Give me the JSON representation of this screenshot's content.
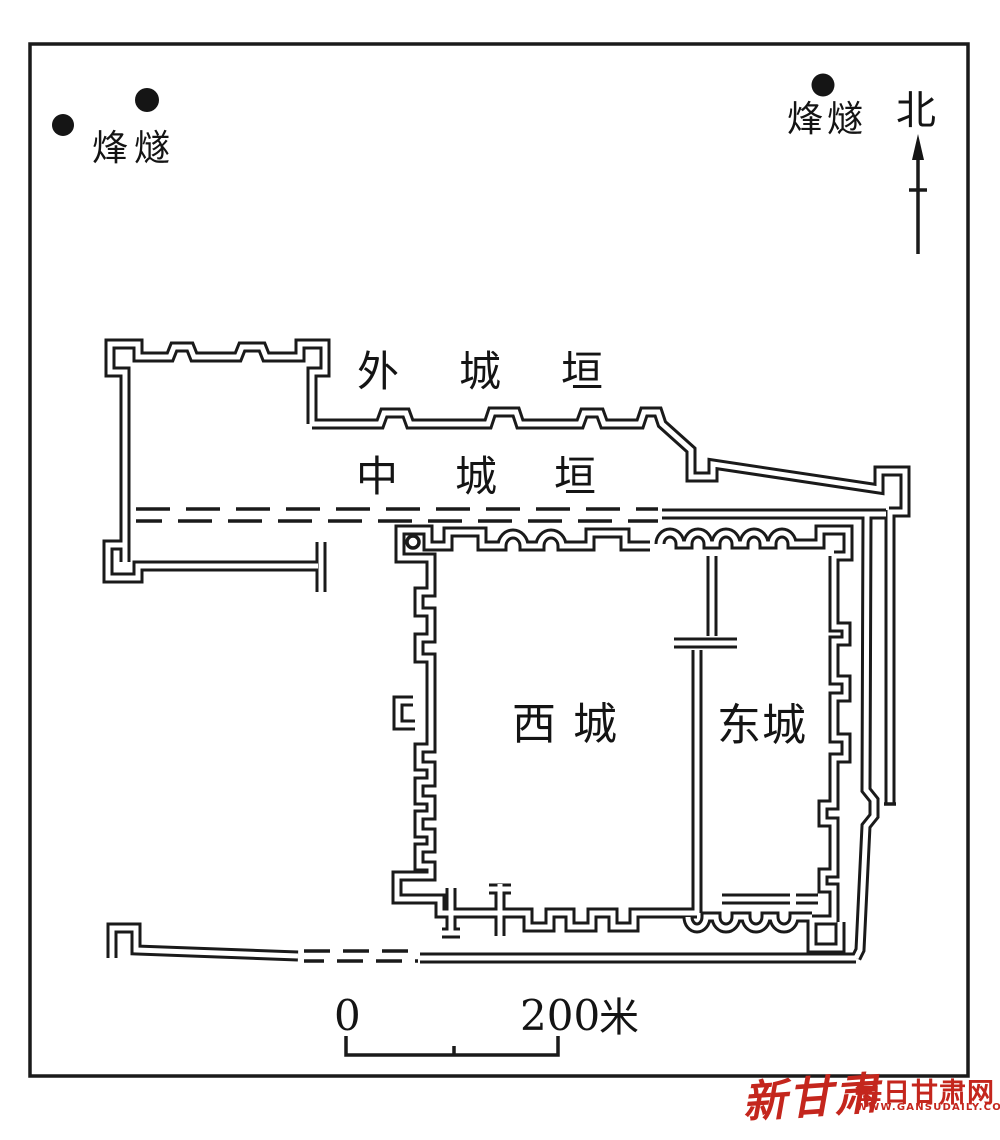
{
  "page": {
    "background": "#ffffff",
    "ink": "#1a1a1a"
  },
  "plan": {
    "beacon_label_left": "烽燧",
    "beacon_label_right": "烽燧",
    "north_label": "北",
    "outer_wall_label": "外城垣",
    "middle_wall_label": "中城垣",
    "west_city_label": "西城",
    "east_city_label": "东城",
    "beacon_dots": [
      {
        "x": 63,
        "y": 125
      },
      {
        "x": 147,
        "y": 100
      },
      {
        "x": 823,
        "y": 85
      }
    ]
  },
  "scale_bar": {
    "zero": "0",
    "max": "200",
    "unit": "米"
  },
  "watermark": {
    "brand": "新甘肃",
    "site": "每日甘肃网",
    "url": "WWW.GANSUDAILY.COM.CN",
    "color": "#c4261d"
  }
}
